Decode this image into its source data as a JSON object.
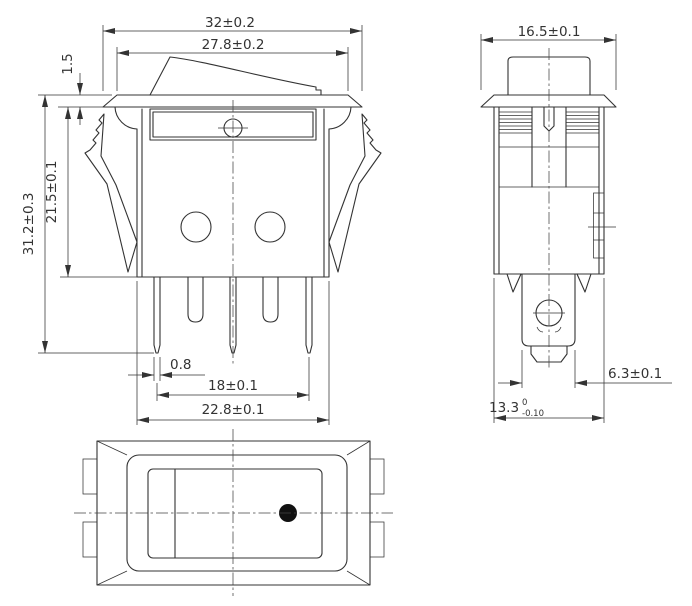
{
  "colors": {
    "line": "#333333",
    "background": "#ffffff",
    "indicator_dot": "#111111"
  },
  "dimensions": {
    "front": {
      "overall_width": "32±0.2",
      "flange_top_width": "27.8±0.2",
      "flange_thickness": "1.5",
      "body_height": "21.5±0.1",
      "overall_height": "31.2±0.3",
      "pin_thickness": "0.8",
      "outer_pin_span": "18±0.1",
      "body_width": "22.8±0.1"
    },
    "side": {
      "flange_width": "16.5±0.1",
      "terminal_width": "6.3±0.1",
      "body_depth_base": "13.3",
      "body_depth_tol_upper": "0",
      "body_depth_tol_lower": "-0.10"
    }
  }
}
